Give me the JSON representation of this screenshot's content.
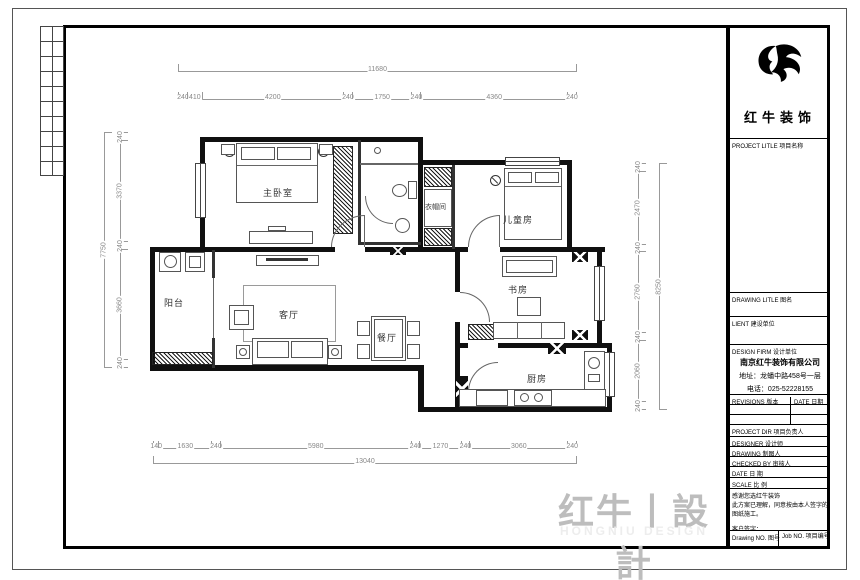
{
  "sheet": {
    "watermark": "红牛丨設計",
    "watermark_sub": "HONGNIU DESIGN"
  },
  "brand": {
    "name": "红牛装饰"
  },
  "rooms": {
    "master": "主卧室",
    "closet": "衣帽间",
    "kids": "儿童房",
    "study": "书房",
    "balcony": "阳台",
    "living": "客厅",
    "dining": "餐厅",
    "kitchen": "厨房"
  },
  "dimensions": {
    "top_total": [
      11680
    ],
    "top": [
      240,
      410,
      4200,
      240,
      1750,
      240,
      4360,
      240
    ],
    "left_total": [
      7750
    ],
    "left": [
      240,
      3370,
      240,
      3660,
      240
    ],
    "right": [
      240,
      2470,
      240,
      2760,
      240,
      2060,
      240
    ],
    "right_total": [
      8250
    ],
    "bottom": [
      140,
      1630,
      240,
      5980,
      240,
      1270,
      240,
      3060,
      240
    ],
    "bottom_total": [
      13040
    ]
  },
  "title_block": {
    "project_label": "PROJECT LITLE  项目名称",
    "drawing_label": "DRAWING LITLE  图名",
    "client_label": "LIENT  建设单位",
    "firm_label": "DESIGN FIRM  设计单位",
    "company_name": "南京红牛装饰有限公司",
    "company_address": "地址：龙蟠中路458号一层",
    "company_phone": "电话：025-52228155",
    "revisions_label": "REVISIONS  版本",
    "date_col_label": "DATE  日期",
    "director_label": "PROJECT DIR  项目负责人",
    "designer_label": "DESIGNER  设计师",
    "drafter_label": "DRAWING  制图人",
    "checker_label": "CHECKED BY  审核人",
    "date_label": "DATE  日  期",
    "scale_label": "SCALE  比  例",
    "note_line1": "感谢您选红牛装饰",
    "note_line2": "此方案已理解，同意按由本人签字的图纸施工。",
    "note_line3": "客户签字：",
    "drawing_no_label": "Drawing NO. 图号",
    "job_no_label": "Job NO. 项目编号"
  }
}
